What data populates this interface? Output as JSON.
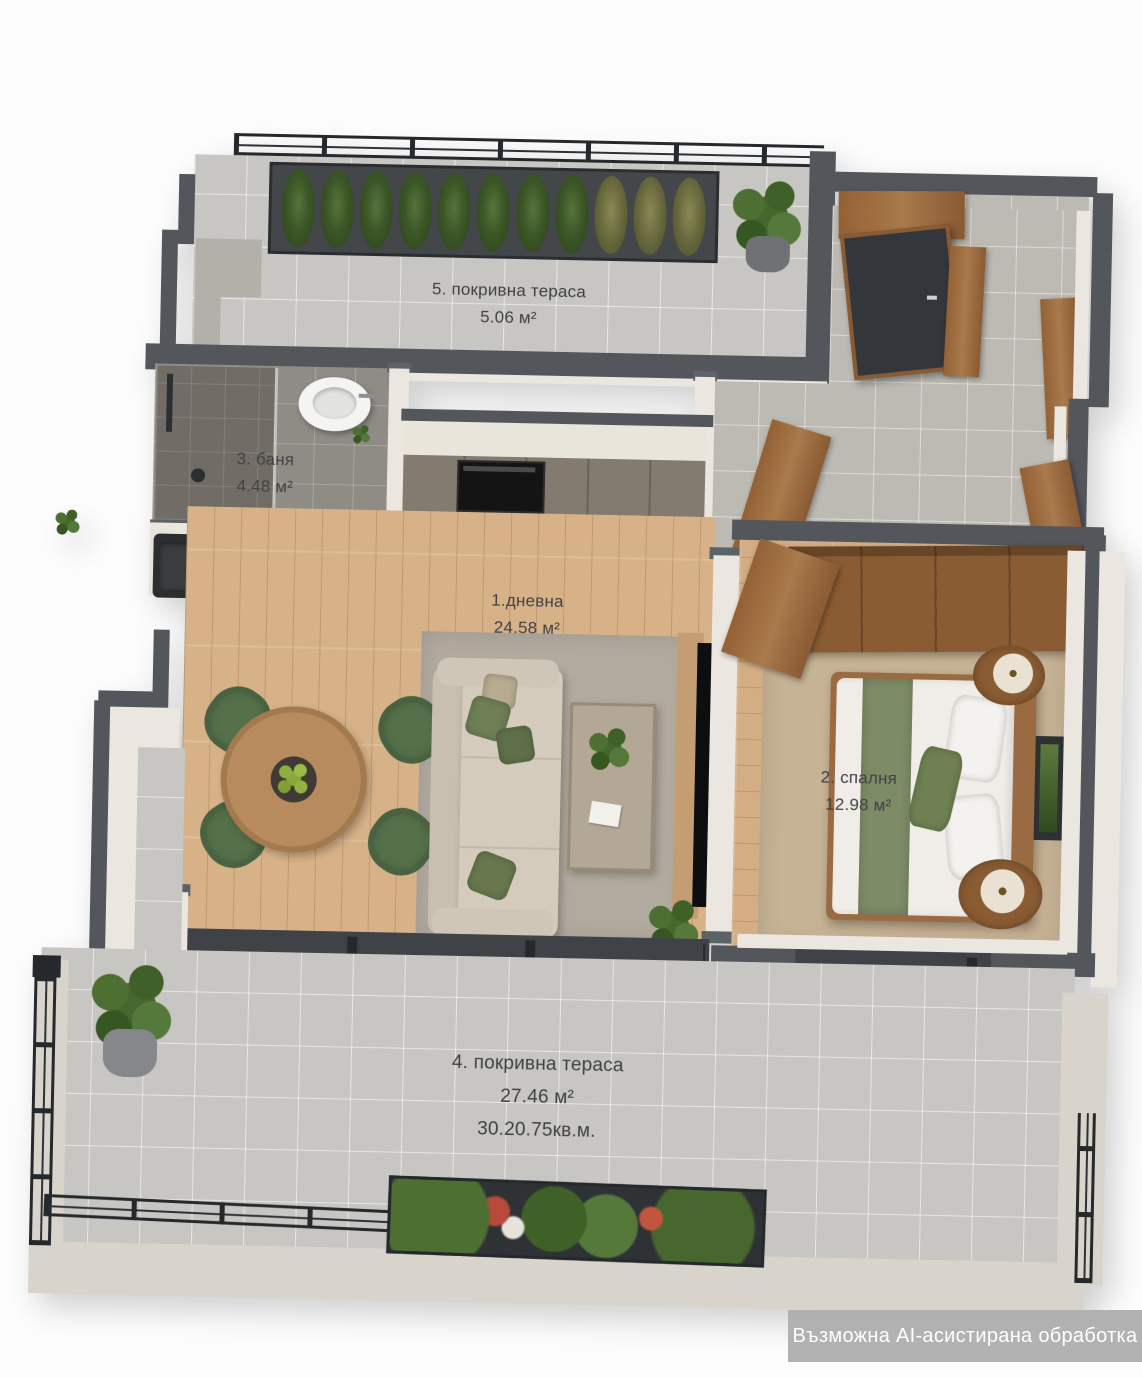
{
  "title": "3D floor plan render (top-down apartment visualization)",
  "rooms": [
    {
      "num": "1",
      "label": "1.дневна",
      "area": "24.58 м²"
    },
    {
      "num": "2",
      "label": "2. спалня",
      "area": "12.98 м²"
    },
    {
      "num": "3",
      "label": "3. баня",
      "area": "4.48 м²"
    },
    {
      "num": "4",
      "label": "4. покривна тераса",
      "area": "27.46 м²",
      "area_alt": "30.20.75кв.м."
    },
    {
      "num": "5",
      "label": "5. покривна тераса",
      "area": "5.06 м²"
    }
  ],
  "watermark": {
    "text": "Възможна AI-асистирана обработка"
  },
  "colors": {
    "background": "#fdfdfd",
    "outer_wall": "#53575c",
    "railing": "#26292c",
    "terrace_tile": "#c7c6c2",
    "bath_tile": "#8f8b85",
    "wood_floor": "#d7b289",
    "accent_green": "#5f7a4a",
    "furniture_wood": "#8a5c33",
    "label_text": "#414144",
    "watermark_bg": "#aeaeae"
  }
}
